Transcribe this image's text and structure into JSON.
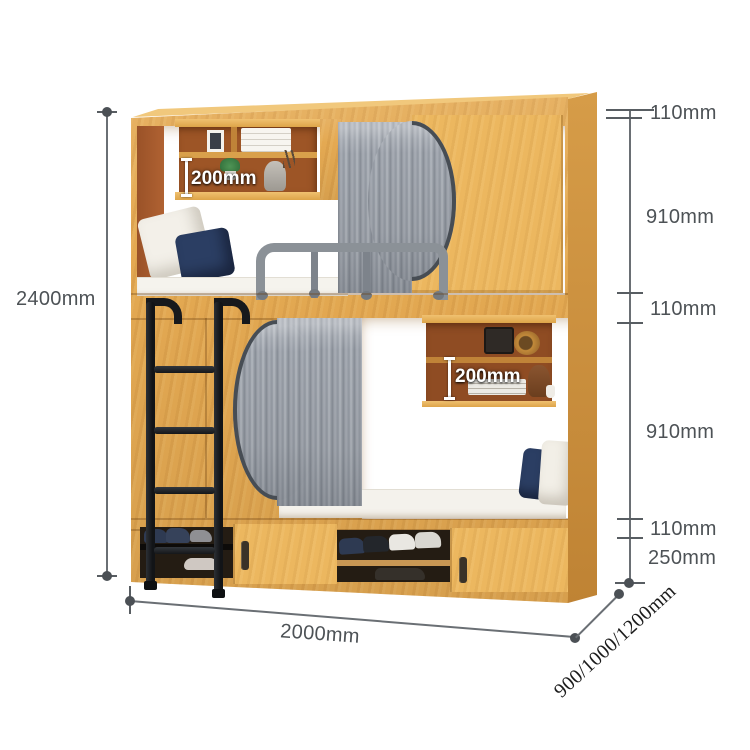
{
  "title": "Bunk bed with storage - dimension diagram",
  "dims": {
    "height": "2400mm",
    "width": "2000mm",
    "depth": "900/1000/1200mm",
    "right": [
      "110mm",
      "910mm",
      "110mm",
      "910mm",
      "110mm",
      "250mm"
    ]
  },
  "labels": {
    "shelf_top": "200mm",
    "shelf_bottom": "200mm"
  },
  "colors": {
    "wood": "#e4a952",
    "wood_side": "#c98f3e",
    "wood_top": "#f1c87c",
    "shelf_interior": "#9d5526",
    "curtain": "#9aa0a8",
    "ladder": "#17191c",
    "mattress": "#f4f2ec",
    "pillow_navy": "#2b3e63",
    "dimension_line": "#6a6f74",
    "dimension_text": "#4d5256",
    "shelf_label_text": "#ffffff"
  }
}
